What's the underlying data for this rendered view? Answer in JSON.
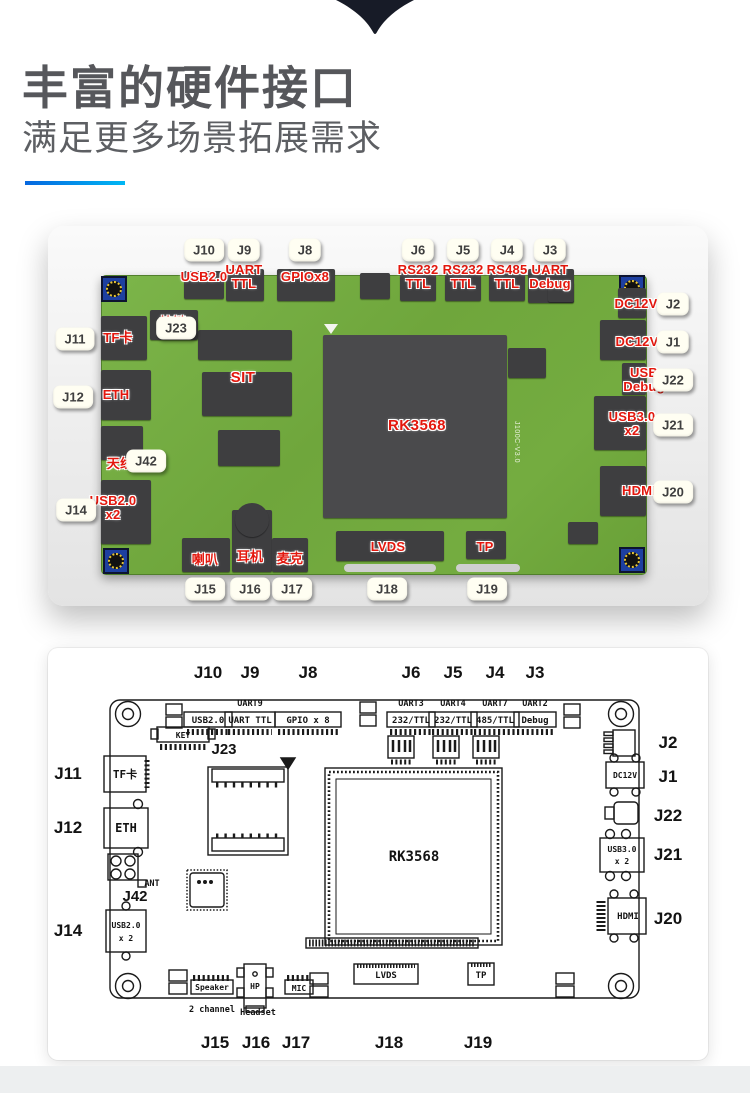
{
  "header": {
    "title": "丰富的硬件接口",
    "subtitle": "满足更多场景拓展需求"
  },
  "colors": {
    "accent_start": "#0667df",
    "accent_end": "#00b7f4",
    "label_red": "#e3170d",
    "board_green": "#74ad3f",
    "arrow_navy": "#171b27"
  },
  "photo": {
    "silkscreen": "J100C-V3.0",
    "badges": {
      "j10": "J10",
      "j9": "J9",
      "j8": "J8",
      "j6": "J6",
      "j5": "J5",
      "j4": "J4",
      "j3": "J3",
      "j11": "J11",
      "j12": "J12",
      "j14": "J14",
      "j23": "J23",
      "j42": "J42",
      "j2": "J2",
      "j1": "J1",
      "j22": "J22",
      "j21": "J21",
      "j20": "J20",
      "j15": "J15",
      "j16": "J16",
      "j17": "J17",
      "j18": "J18",
      "j19": "J19"
    },
    "ports": {
      "usb20": "USB2.0",
      "uart_ttl": "UART\nTTL",
      "gpiox8": "GPIOx8",
      "rs232_a": "RS232\nTTL",
      "rs232_b": "RS232\nTTL",
      "rs485_ttl": "RS485\nTTL",
      "uart_debug": "UART\nDebug",
      "key": "按键",
      "tf": "TF卡",
      "eth": "ETH",
      "antenna": "天线",
      "usb20_x2": "USB2.0\nx2",
      "sit": "SIT",
      "dc12v_a": "DC12V",
      "dc12v_b": "DC12V",
      "usb_debug": "USB\nDebug",
      "usb30_x2": "USB3.0\nx2",
      "hdmi": "HDMI",
      "speaker": "喇叭",
      "headphone": "耳机",
      "mic": "麦克",
      "lvds": "LVDS",
      "tp": "TP",
      "chip": "RK3568"
    }
  },
  "diagram": {
    "jlabels": {
      "j10": "J10",
      "j9": "J9",
      "j8": "J8",
      "j6": "J6",
      "j5": "J5",
      "j4": "J4",
      "j3": "J3",
      "j11": "J11",
      "j12": "J12",
      "j14": "J14",
      "j23": "J23",
      "j42": "J42",
      "j2": "J2",
      "j1": "J1",
      "j22": "J22",
      "j21": "J21",
      "j20": "J20",
      "j15": "J15",
      "j16": "J16",
      "j17": "J17",
      "j18": "J18",
      "j19": "J19"
    },
    "small": {
      "uart9": "UART9",
      "uart3": "UART3",
      "uart4": "UART4",
      "uart7": "UART7",
      "uart2": "UART2",
      "ant": "ANT",
      "ch2": "2 channel",
      "headset": "Headset"
    },
    "boxes": {
      "usb20": "USB2.0",
      "uart_ttl": "UART TTL",
      "gpio": "GPIO x 8",
      "c232a": "232/TTL",
      "c232b": "232/TTL",
      "c485": "485/TTL",
      "debug": "Debug",
      "key": "KEY",
      "tf": "TF卡",
      "eth": "ETH",
      "usb20_l1": "USB2.0",
      "usb20_l2": "x 2",
      "dc12v": "DC12V",
      "usb30_l1": "USB3.0",
      "usb30_l2": "x 2",
      "hdmi": "HDMI",
      "speaker": "Speaker",
      "hp": "HP",
      "mic": "MIC",
      "lvds": "LVDS",
      "tp": "TP",
      "chip": "RK3568"
    }
  }
}
